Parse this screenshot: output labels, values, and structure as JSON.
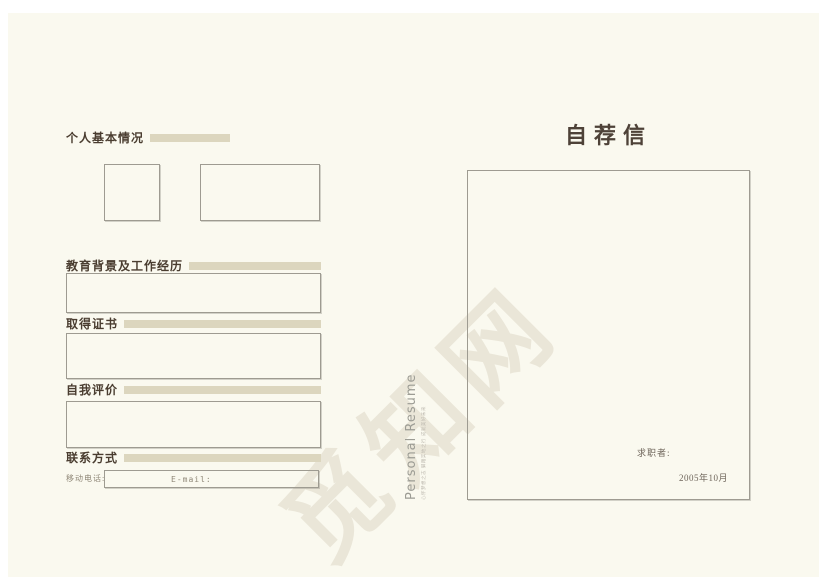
{
  "colors": {
    "page_background": "#FAF9EF",
    "accent_bar": "#DCD6BE",
    "heading_text": "#4A3D30",
    "box_border": "#9E9B91",
    "watermark": "#EAE6D8"
  },
  "watermark": {
    "text": "觅知网"
  },
  "left_page": {
    "sections": [
      {
        "title": "个人基本情况"
      },
      {
        "title": "教育背景及工作经历"
      },
      {
        "title": "取得证书"
      },
      {
        "title": "自我评价"
      },
      {
        "title": "联系方式"
      }
    ],
    "contact": {
      "mobile_label": "移动电话:",
      "email_label": "E-mail:"
    }
  },
  "spine": {
    "title": "Personal Resume",
    "tagline": "心怀梦想之志 脚踏实地之行 成就美好未来"
  },
  "right_page": {
    "title": "自荐信",
    "applicant_label": "求职者:",
    "date": "2005年10月"
  }
}
